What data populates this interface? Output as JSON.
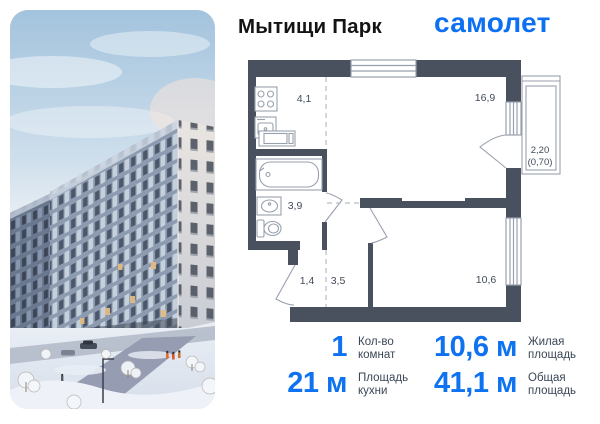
{
  "header": {
    "title": "Мытищи Парк",
    "logo": "самолет"
  },
  "plan": {
    "kitchen_area": "4,1",
    "living_area": "16,9",
    "bathroom_area": "3,9",
    "hall_area": "1,4",
    "corridor_area": "3,5",
    "bedroom_area": "10,6",
    "balcony_area": "2,20",
    "balcony_area_reduced": "(0,70)"
  },
  "stats": [
    {
      "value": "1",
      "label1": "Кол-во",
      "label2": "комнат"
    },
    {
      "value": "10,6 м",
      "label1": "Жилая",
      "label2": "площадь"
    },
    {
      "value": "21 м",
      "label1": "Площадь",
      "label2": "кухни"
    },
    {
      "value": "41,1 м",
      "label1": "Общая",
      "label2": "площадь"
    }
  ],
  "colors": {
    "accent_blue": "#0e72f1",
    "logo_blue": "#0c70f3",
    "plan_wall": "#49505e",
    "plan_line": "#99a0ad",
    "label_gray": "#3a4756"
  }
}
